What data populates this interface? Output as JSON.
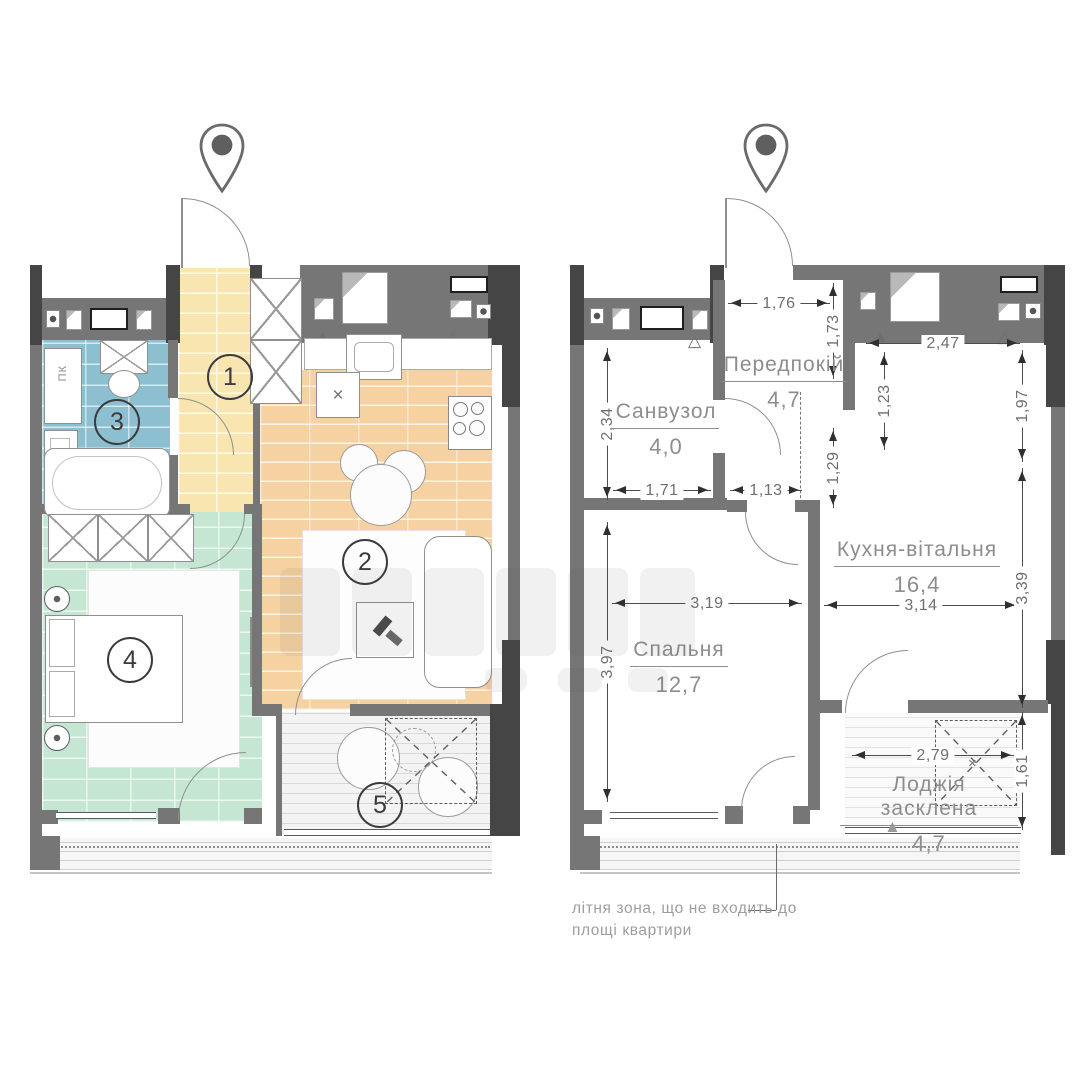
{
  "colors": {
    "wall": "#767676",
    "wall_dark": "#454545",
    "tile_blue": "#8cc0d1",
    "tile_green": "#c6e6d4",
    "tile_yellow": "#f8e5af",
    "wood": "#f6d2a2",
    "dim_text": "#6f6f6f",
    "label_text": "#8d8d8d"
  },
  "symbols": {
    "cross": "×",
    "tri_filled": "▲",
    "tri_outline": "△"
  },
  "left_plan": {
    "markers": [
      "1",
      "2",
      "3",
      "4",
      "5"
    ],
    "washer_label": "ПК"
  },
  "right_plan": {
    "rooms": {
      "sanvuzol": {
        "name": "Санвузол",
        "area": "4,0"
      },
      "peredpokiy": {
        "name": "Передпокій",
        "area": "4,7"
      },
      "kitchen": {
        "name": "Кухня-вітальня",
        "area": "16,4"
      },
      "bedroom": {
        "name": "Спальня",
        "area": "12,7"
      },
      "loggia": {
        "name": "Лоджія засклена",
        "area": "4,7"
      }
    },
    "dims": {
      "hall_top_w": "1,76",
      "hall_right_h": "1,73",
      "kitchen_top_w": "2,47",
      "kitchen_left_h": "1,23",
      "kitchen_right_h1": "1,97",
      "san_left_h": "2,34",
      "hall_bottom_h": "1,29",
      "san_bottom_w": "1,71",
      "hall_bottom_w": "1,13",
      "bedroom_w": "3,19",
      "kitchen_w": "3,14",
      "kitchen_right_h2": "3,39",
      "bedroom_h": "3,97",
      "loggia_w": "2,79",
      "loggia_h": "1,61"
    }
  },
  "note": {
    "line1": "літня зона, що не входить до",
    "line2": "площі квартири"
  }
}
